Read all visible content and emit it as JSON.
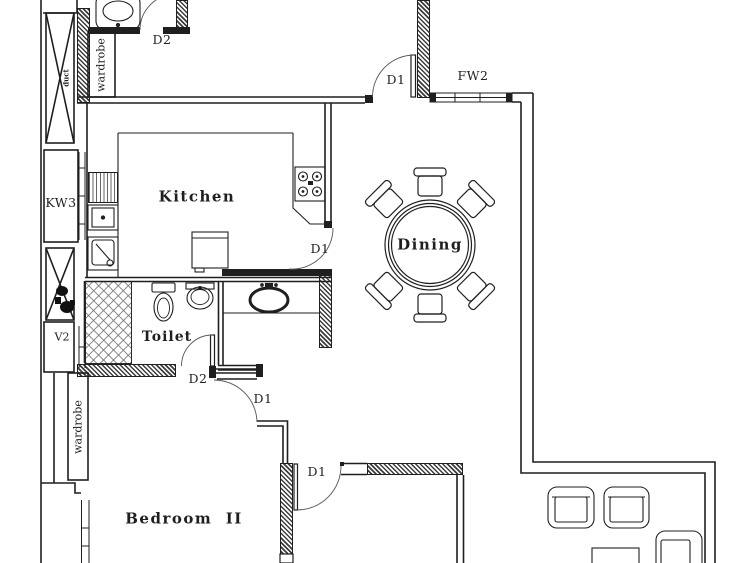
{
  "colors": {
    "ink": "#1f1f1f",
    "paper": "#ffffff",
    "hatch": "#3d3d3d",
    "tile": "#6e6e6e"
  },
  "labels": {
    "kitchen": "Kitchen",
    "dining": "Dining",
    "toilet": "Toilet",
    "bedroom2": "Bedroom  II",
    "wardrobe_top": "wardrobe",
    "wardrobe_bottom": "wardrobe",
    "duct": "duct",
    "kw3": "KW3",
    "v2": "V2",
    "fw2": "FW2",
    "d2_bath": "D2",
    "d1_entry": "D1",
    "d1_kitchen": "D1",
    "d2_toilet": "D2",
    "d1_corridor": "D1",
    "d1_bedroom": "D1"
  }
}
